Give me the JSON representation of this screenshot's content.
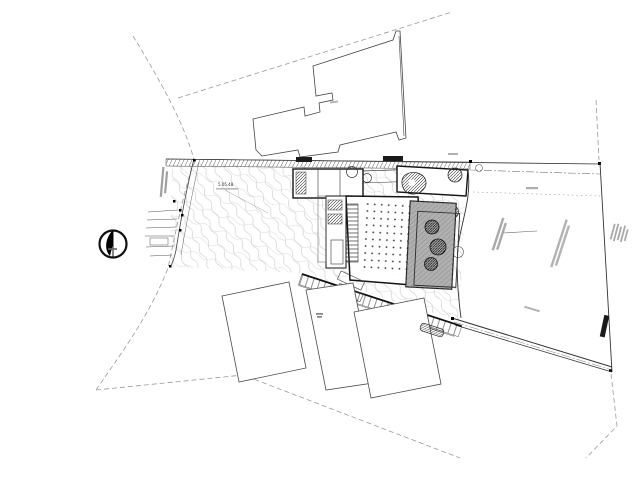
{
  "drawing": {
    "kind": "architectural-site-plan",
    "annotations": {
      "elevation_note": "5.05.48"
    },
    "colors": {
      "paper": "#ffffff",
      "line_dark": "#1a1a1a",
      "line_medium": "#555555",
      "contour_light": "#c6c6c6",
      "road_dash": "#9a9a9a",
      "building_fill": "#b0b0b0"
    },
    "icons": {
      "north_arrow": "compass-north-arrow"
    }
  }
}
